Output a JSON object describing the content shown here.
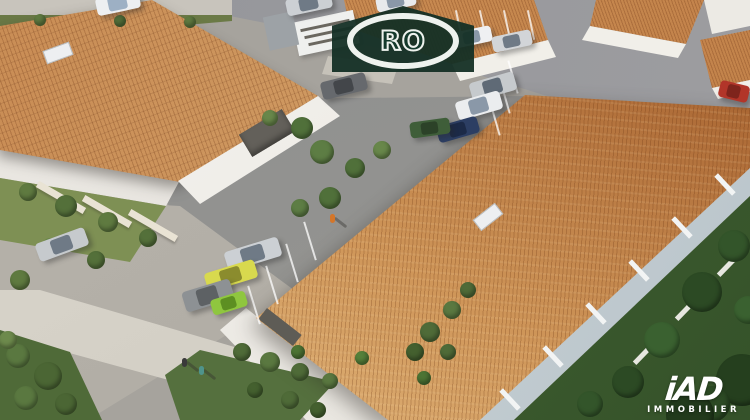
{
  "watermark": {
    "text": "RO"
  },
  "agency": {
    "name": "iAD",
    "tagline": "IMMOBILIER"
  },
  "scene": {
    "description": "Aerial 3D architectural rendering of a residential complex with terracotta tiled roofs, white facades, parking areas, gardens and streets",
    "palette": {
      "roof_terracotta": "#c98d55",
      "roof_sand_light": "#e3b97f",
      "roof_sand_dark": "#a5602e",
      "wall_white": "#f5f3ef",
      "asphalt": "#919296",
      "concrete": "#d7d3c9",
      "lawn": "#7e9054",
      "hedge": "#55703e",
      "trees_dark": "#2c4a24",
      "logo_green": "#14392b"
    },
    "cars": [
      {
        "x": 96,
        "y": -6,
        "w": 44,
        "h": 18,
        "r": -12,
        "b": "#edeff1",
        "g": "#9db0c4"
      },
      {
        "x": 286,
        "y": -5,
        "w": 46,
        "h": 17,
        "r": -12,
        "b": "#ccd0d4",
        "g": "#6f7a86"
      },
      {
        "x": 376,
        "y": -6,
        "w": 40,
        "h": 15,
        "r": -12,
        "b": "#e8eaec",
        "g": "#8a98a8"
      },
      {
        "x": 452,
        "y": 29,
        "w": 40,
        "h": 16,
        "r": -12,
        "b": "#eff0f2",
        "g": "#8a98a8"
      },
      {
        "x": 492,
        "y": 33,
        "w": 40,
        "h": 16,
        "r": -12,
        "b": "#d2d5d8",
        "g": "#6f7a86"
      },
      {
        "x": 470,
        "y": 77,
        "w": 46,
        "h": 19,
        "r": -16,
        "b": "#c6cacd",
        "g": "#5f6a76"
      },
      {
        "x": 456,
        "y": 96,
        "w": 46,
        "h": 19,
        "r": -16,
        "b": "#ebedef",
        "g": "#8a98a8"
      },
      {
        "x": 437,
        "y": 121,
        "w": 42,
        "h": 17,
        "r": -16,
        "b": "#2c3e63",
        "g": "#1c2a47"
      },
      {
        "x": 410,
        "y": 120,
        "w": 40,
        "h": 16,
        "r": -8,
        "b": "#3f5e39",
        "g": "#2c4228"
      },
      {
        "x": 321,
        "y": 77,
        "w": 46,
        "h": 18,
        "r": -14,
        "b": "#66696d",
        "g": "#43464a"
      },
      {
        "x": 719,
        "y": 83,
        "w": 30,
        "h": 17,
        "r": 14,
        "b": "#b23529",
        "g": "#7e241c"
      },
      {
        "x": 225,
        "y": 244,
        "w": 56,
        "h": 20,
        "r": -17,
        "b": "#ccd0d4",
        "g": "#6f7a86"
      },
      {
        "x": 205,
        "y": 266,
        "w": 52,
        "h": 19,
        "r": -17,
        "b": "#d8d94e",
        "g": "#8b8c2e"
      },
      {
        "x": 183,
        "y": 285,
        "w": 50,
        "h": 21,
        "r": -17,
        "b": "#8d9194",
        "g": "#5d6164"
      },
      {
        "x": 211,
        "y": 295,
        "w": 36,
        "h": 16,
        "r": -17,
        "b": "#8fc63f",
        "g": "#5d8f22"
      },
      {
        "x": 36,
        "y": 235,
        "w": 52,
        "h": 19,
        "r": -20,
        "b": "#c6cacd",
        "g": "#6f7a86"
      }
    ],
    "trees": [
      {
        "x": 734,
        "y": 246,
        "r": 16,
        "c": "#33552a"
      },
      {
        "x": 702,
        "y": 292,
        "r": 20,
        "c": "#2c4a24"
      },
      {
        "x": 662,
        "y": 340,
        "r": 18,
        "c": "#3a6130"
      },
      {
        "x": 628,
        "y": 382,
        "r": 16,
        "c": "#2c4a24"
      },
      {
        "x": 590,
        "y": 404,
        "r": 13,
        "c": "#33552a"
      },
      {
        "x": 742,
        "y": 380,
        "r": 26,
        "c": "#253f1e"
      },
      {
        "x": 712,
        "y": 404,
        "r": 18,
        "c": "#2c4a24"
      },
      {
        "x": 748,
        "y": 310,
        "r": 14,
        "c": "#3a6130"
      },
      {
        "x": 690,
        "y": 415,
        "r": 24,
        "c": "#223a1c"
      },
      {
        "x": 298,
        "y": 352,
        "r": 7,
        "c": "#4d7434"
      },
      {
        "x": 362,
        "y": 358,
        "r": 7,
        "c": "#55803a"
      },
      {
        "x": 424,
        "y": 378,
        "r": 7,
        "c": "#4d7434"
      },
      {
        "x": 28,
        "y": 192,
        "r": 9,
        "c": "#5f7a40"
      },
      {
        "x": 66,
        "y": 206,
        "r": 11,
        "c": "#54703a"
      },
      {
        "x": 108,
        "y": 222,
        "r": 10,
        "c": "#5f7a40"
      },
      {
        "x": 148,
        "y": 238,
        "r": 9,
        "c": "#54703a"
      },
      {
        "x": 50,
        "y": 246,
        "r": 8,
        "c": "#6d8a4c"
      },
      {
        "x": 96,
        "y": 260,
        "r": 9,
        "c": "#54703a"
      },
      {
        "x": 20,
        "y": 280,
        "r": 10,
        "c": "#5f7a40"
      },
      {
        "x": 302,
        "y": 128,
        "r": 11,
        "c": "#50703a"
      },
      {
        "x": 322,
        "y": 152,
        "r": 12,
        "c": "#5d7d44"
      },
      {
        "x": 355,
        "y": 168,
        "r": 10,
        "c": "#50703a"
      },
      {
        "x": 382,
        "y": 150,
        "r": 9,
        "c": "#68874a"
      },
      {
        "x": 330,
        "y": 198,
        "r": 11,
        "c": "#50703a"
      },
      {
        "x": 300,
        "y": 208,
        "r": 9,
        "c": "#5d7d44"
      },
      {
        "x": 270,
        "y": 118,
        "r": 8,
        "c": "#68874a"
      },
      {
        "x": 242,
        "y": 352,
        "r": 9,
        "c": "#4f6b38"
      },
      {
        "x": 270,
        "y": 362,
        "r": 10,
        "c": "#5a7840"
      },
      {
        "x": 300,
        "y": 372,
        "r": 9,
        "c": "#4f6b38"
      },
      {
        "x": 330,
        "y": 381,
        "r": 8,
        "c": "#5a7840"
      },
      {
        "x": 255,
        "y": 390,
        "r": 8,
        "c": "#44602f"
      },
      {
        "x": 290,
        "y": 400,
        "r": 9,
        "c": "#4f6b38"
      },
      {
        "x": 318,
        "y": 410,
        "r": 8,
        "c": "#44602f"
      },
      {
        "x": 430,
        "y": 332,
        "r": 10,
        "c": "#4f6b38"
      },
      {
        "x": 452,
        "y": 310,
        "r": 9,
        "c": "#5a7840"
      },
      {
        "x": 468,
        "y": 290,
        "r": 8,
        "c": "#4f6b38"
      },
      {
        "x": 415,
        "y": 352,
        "r": 9,
        "c": "#44602f"
      },
      {
        "x": 448,
        "y": 352,
        "r": 8,
        "c": "#4f6b38"
      },
      {
        "x": 18,
        "y": 356,
        "r": 12,
        "c": "#5a7840"
      },
      {
        "x": 48,
        "y": 376,
        "r": 14,
        "c": "#4b6634"
      },
      {
        "x": 26,
        "y": 398,
        "r": 12,
        "c": "#5a7840"
      },
      {
        "x": 66,
        "y": 404,
        "r": 11,
        "c": "#4b6634"
      },
      {
        "x": 8,
        "y": 340,
        "r": 9,
        "c": "#6d8a4c"
      },
      {
        "x": 40,
        "y": 20,
        "r": 6,
        "c": "#5f7a40"
      },
      {
        "x": 120,
        "y": 21,
        "r": 6,
        "c": "#54703a"
      },
      {
        "x": 190,
        "y": 22,
        "r": 6,
        "c": "#5f7a40"
      }
    ],
    "people": [
      {
        "x": 182,
        "y": 358,
        "c": "#3a3a3a"
      },
      {
        "x": 199,
        "y": 366,
        "c": "#4f948c"
      },
      {
        "x": 330,
        "y": 214,
        "c": "#d4762a"
      }
    ]
  }
}
